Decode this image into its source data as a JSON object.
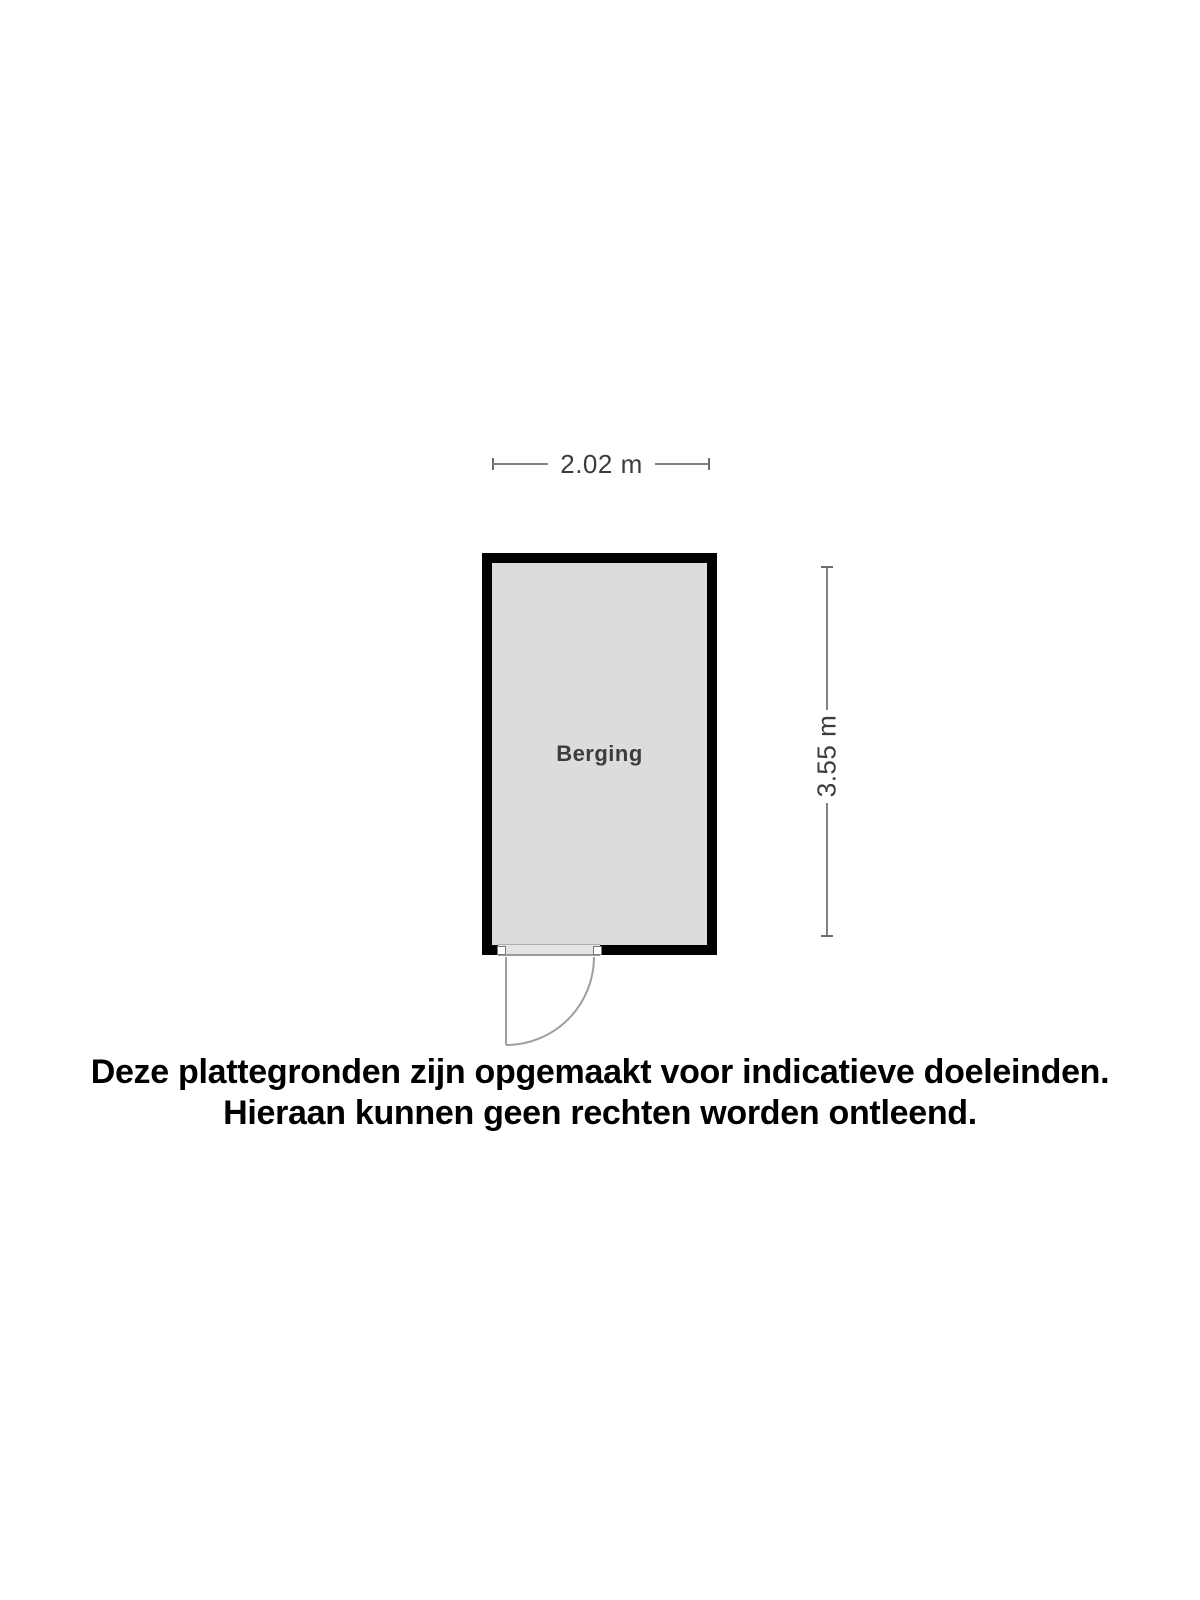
{
  "colors": {
    "background": "#ffffff",
    "wall": "#000000",
    "room_fill": "#dcdcdc",
    "dim_line": "#828282",
    "dim_tick": "#6e6e6e",
    "dim_text": "#3c3c3c",
    "door_line": "#9e9e9e",
    "sill_fill": "#e4e4e4",
    "disclaimer_color": "#000000"
  },
  "floorplan": {
    "room": {
      "label": "Berging"
    },
    "dimensions": {
      "width_label": "2.02 m",
      "height_label": "3.55 m"
    }
  },
  "disclaimer": {
    "line1": "Deze plattegronden zijn opgemaakt voor indicatieve doeleinden.",
    "line2": "Hieraan kunnen geen rechten worden ontleend."
  }
}
